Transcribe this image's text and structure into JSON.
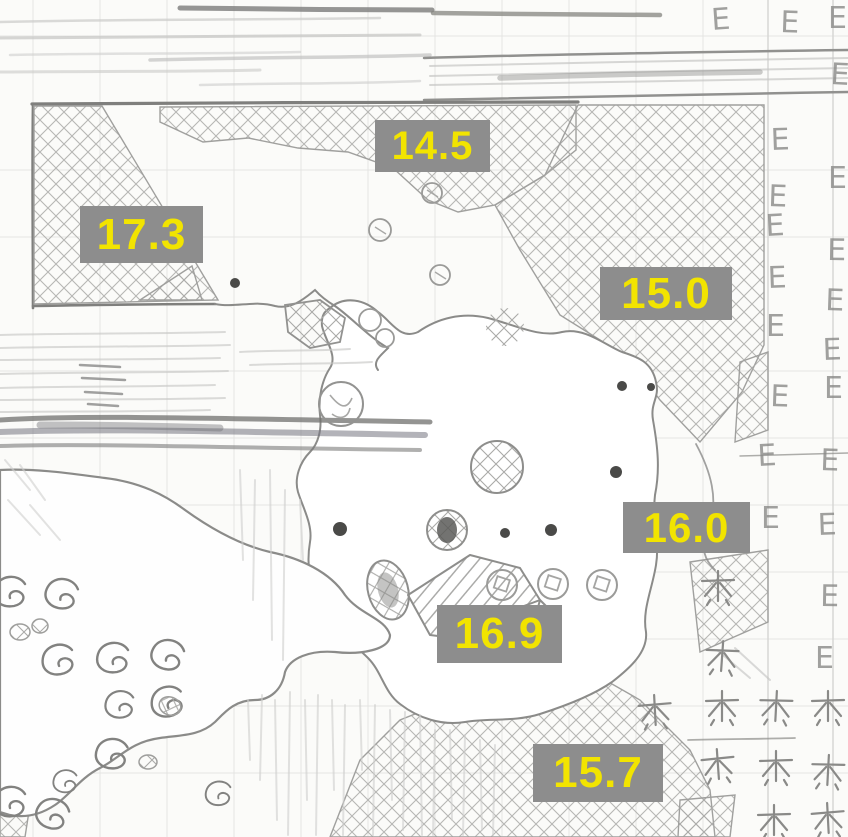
{
  "canvas": {
    "width": 848,
    "height": 837
  },
  "palette": {
    "paper": "#fbfbf9",
    "pencil": "#8f8f8d",
    "pencil_light": "#c7c7c5",
    "pencil_dark": "#6b6b69",
    "grid": "#d8d8d6",
    "label_background": "#8d8d8d",
    "label_text": "#f2e400"
  },
  "labels": [
    {
      "value": "14.5"
    },
    {
      "value": "17.3"
    },
    {
      "value": "15.0"
    },
    {
      "value": "16.0"
    },
    {
      "value": "16.9"
    },
    {
      "value": "15.7"
    }
  ],
  "marks": {
    "letter": "E"
  }
}
